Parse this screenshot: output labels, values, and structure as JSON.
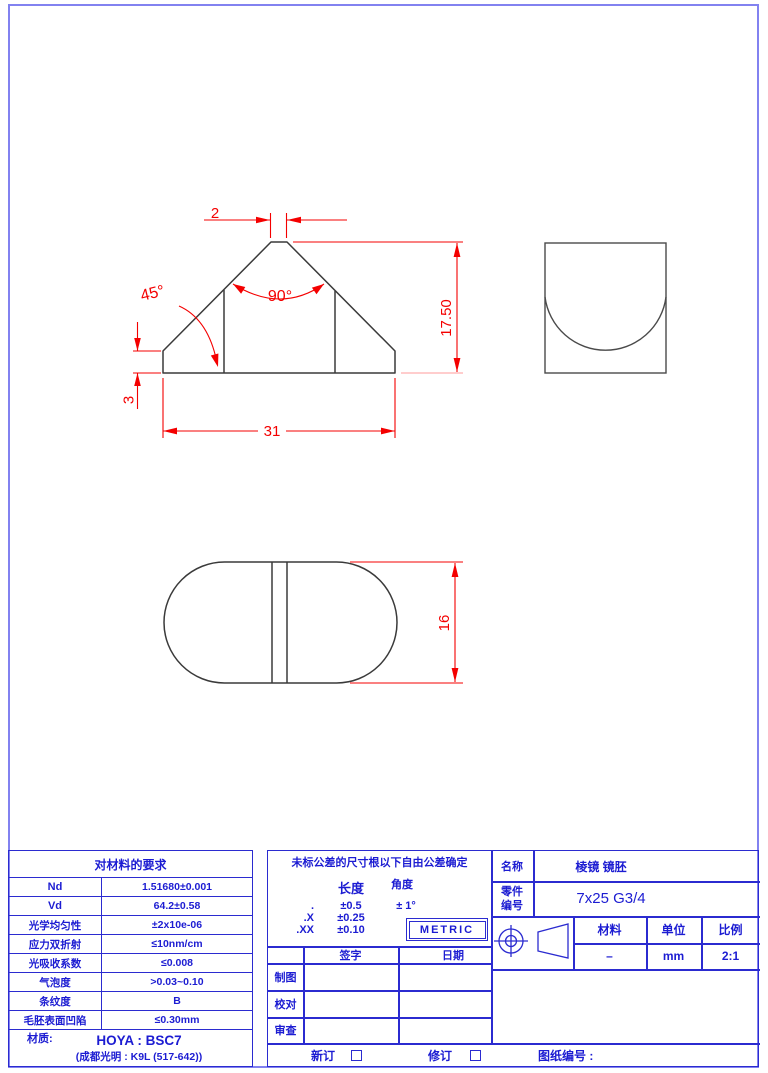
{
  "colors": {
    "dimension_red": "#f40000",
    "table_blue": "#2b2bd0",
    "drawing_line": "#3a3a3a",
    "page_border": "#8282f0"
  },
  "drawing": {
    "front": {
      "top_width": "2",
      "height": "17.50",
      "angle_left": "45°",
      "angle_apex": "90°",
      "edge_height": "3",
      "base_width": "31"
    },
    "plan": {
      "height": "16"
    }
  },
  "material_table": {
    "title": "对材料的要求",
    "rows": [
      {
        "label": "Nd",
        "value": "1.51680±0.001"
      },
      {
        "label": "Vd",
        "value": "64.2±0.58"
      },
      {
        "label": "光学均匀性",
        "value": "±2x10e-06"
      },
      {
        "label": "应力双折射",
        "value": "≤10nm/cm"
      },
      {
        "label": "光吸收系数",
        "value": "≤0.008"
      },
      {
        "label": "气泡度",
        "value": ">0.03~0.10"
      },
      {
        "label": "条纹度",
        "value": "B"
      },
      {
        "label": "毛胚表面凹陷",
        "value": "≤0.30mm"
      }
    ],
    "material_label": "材质:",
    "material_value": "HOYA : BSC7",
    "material_note": "(成都光明 : K9L (517-642))"
  },
  "tolerance_block": {
    "note": "未标公差的尺寸根以下自由公差确定",
    "col_length": "长度",
    "col_angle": "角度",
    "rows": [
      {
        "prec": ".",
        "length": "±0.5",
        "angle": "± 1°"
      },
      {
        "prec": ".X",
        "length": "±0.25",
        "angle": ""
      },
      {
        "prec": ".XX",
        "length": "±0.10",
        "angle": ""
      }
    ],
    "metric": "METRIC",
    "sign_header": "签字",
    "date_header": "日期",
    "sign_rows": [
      "制图",
      "校对",
      "审查"
    ]
  },
  "title_block": {
    "name_label": "名称",
    "name_value": "棱镜 镜胚",
    "part_label_line1": "零件",
    "part_label_line2": "编号",
    "part_value": "7x25 G3/4",
    "material_label": "材料",
    "unit_label": "单位",
    "scale_label": "比例",
    "material_value": "–",
    "unit_value": "mm",
    "scale_value": "2:1"
  },
  "footer": {
    "new_label": "新订",
    "revise_label": "修订",
    "drawing_no_label": "图纸编号 :"
  }
}
